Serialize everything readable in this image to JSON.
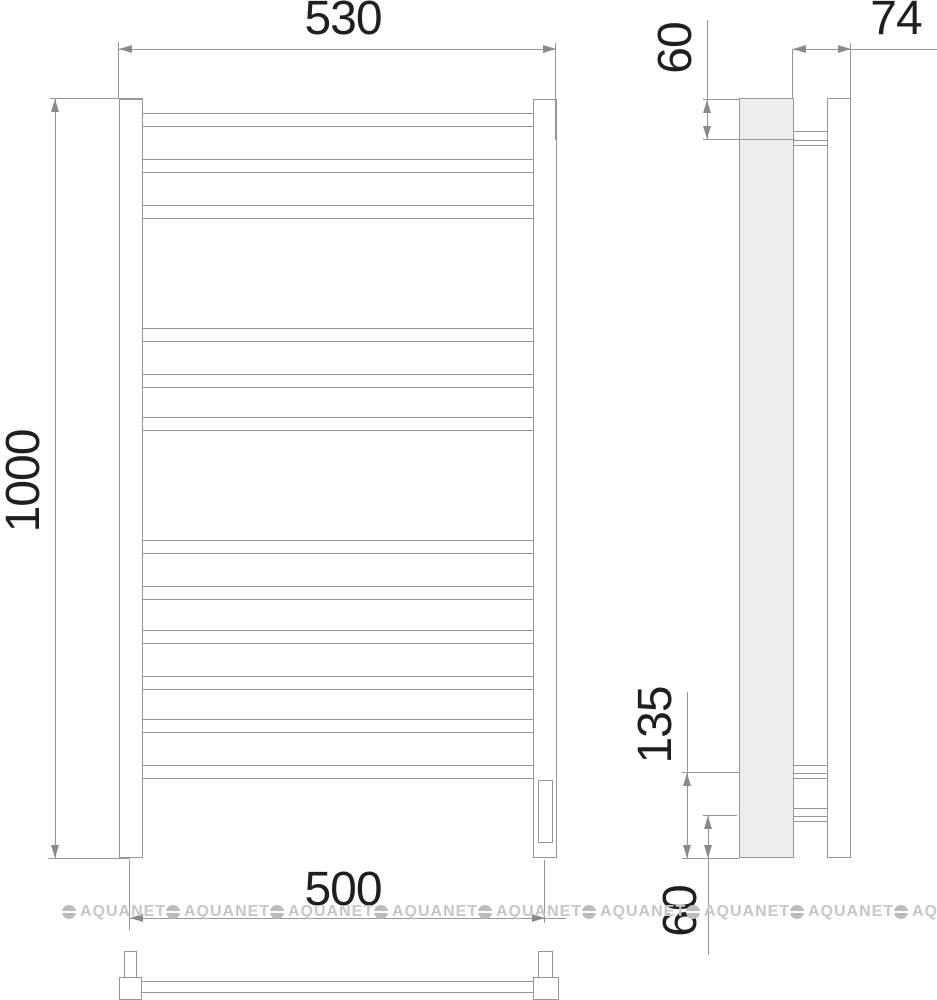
{
  "drawing": {
    "type": "towel-rail technical drawing, front view / side view / top view",
    "dimensions": {
      "front_width_top": "530",
      "front_height": "1000",
      "front_width_bottom": "500",
      "side_depth": "74",
      "side_top_offset": "60",
      "side_bracket_span": "135",
      "side_bottom_offset": "60"
    },
    "watermark": {
      "text": "AQUANET"
    },
    "colors": {
      "line": "#979797",
      "dimension_text": "#1f1f1f",
      "wall_fill": "#ededed",
      "watermark": "#c6c6c6",
      "background": "#ffffff"
    }
  }
}
